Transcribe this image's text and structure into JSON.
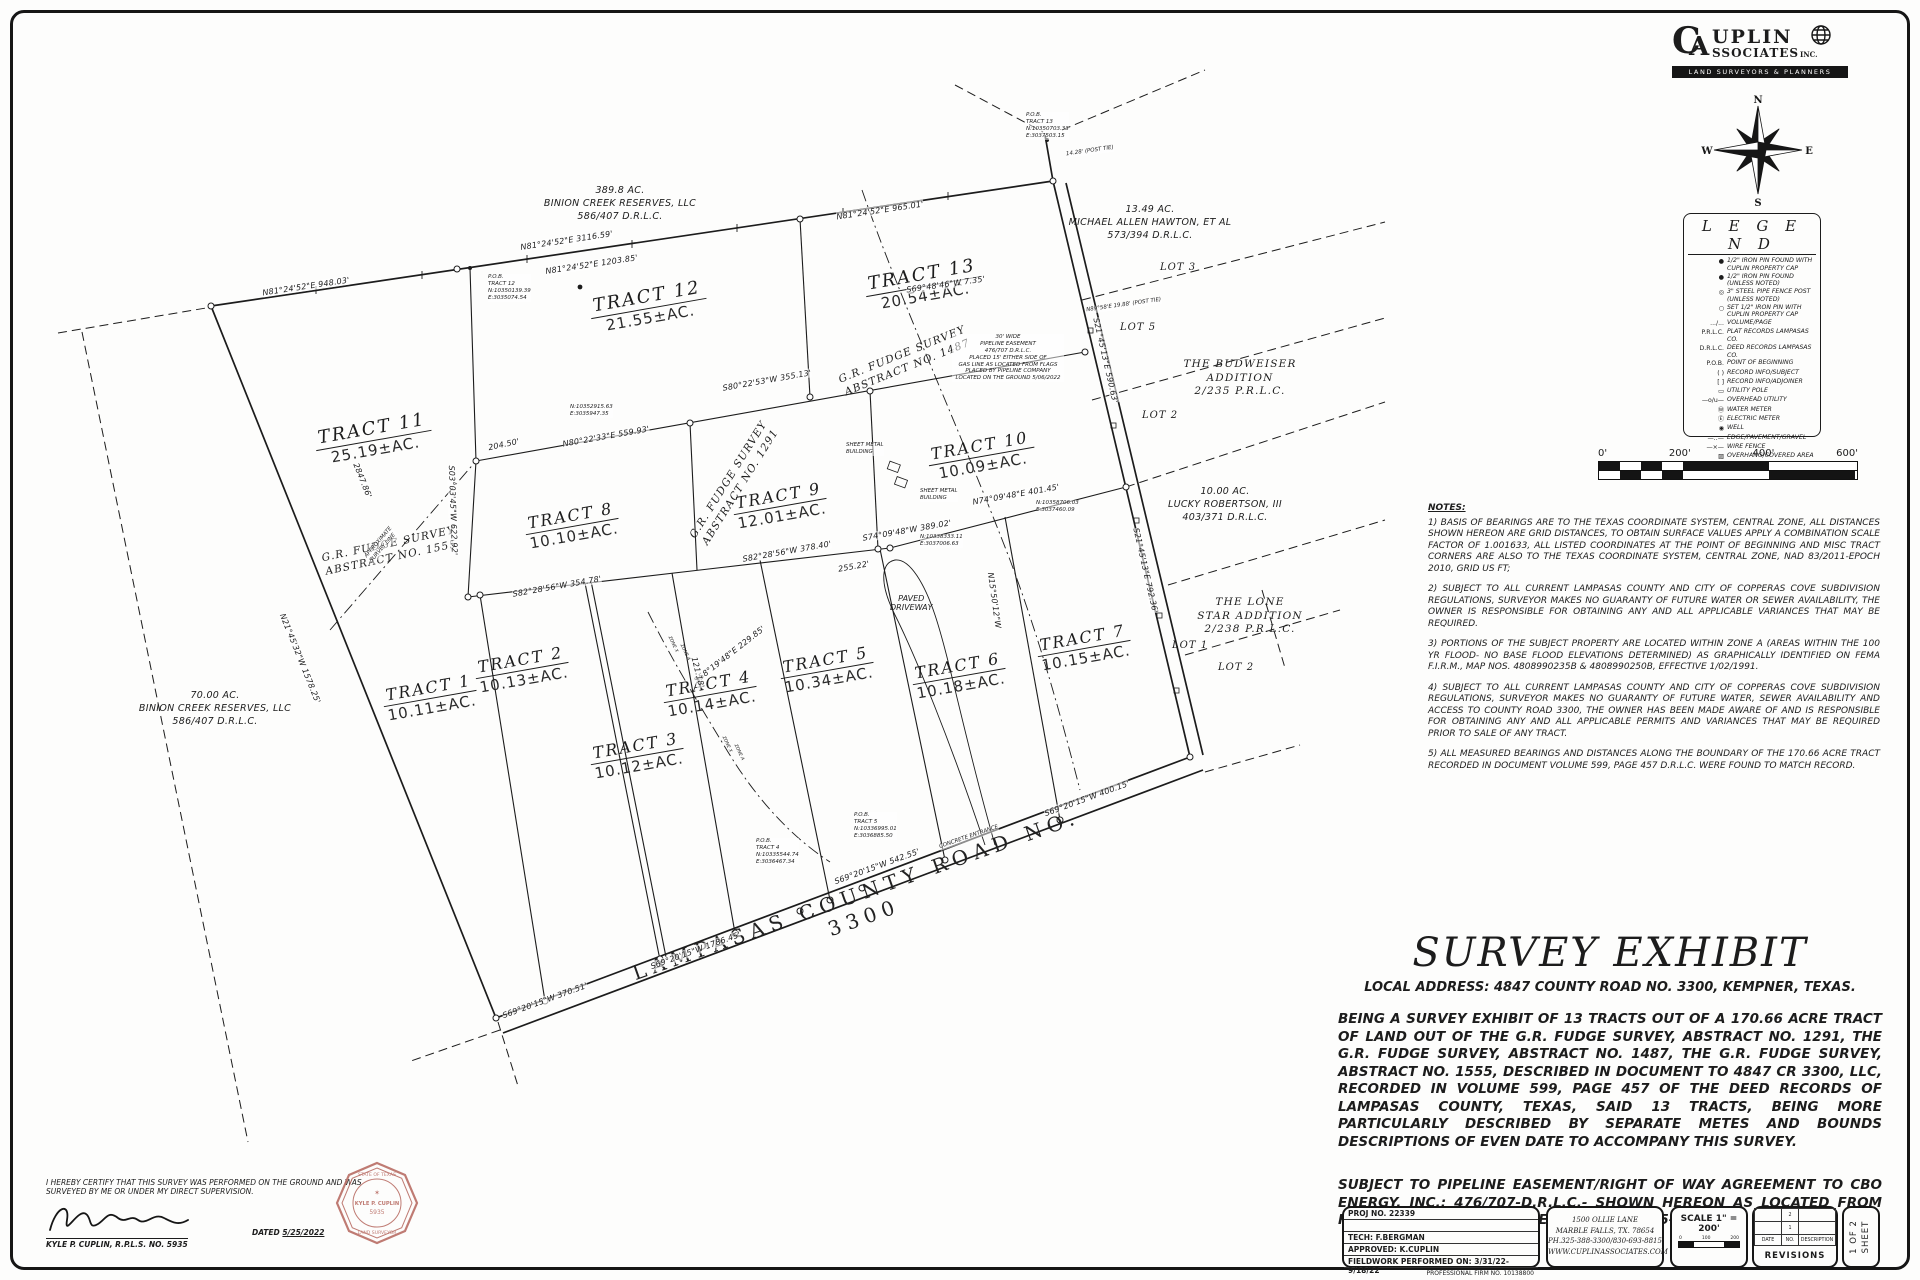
{
  "logo": {
    "c": "C",
    "a": "A",
    "upl": "UPLIN",
    "ssoc": "SSOCIATES",
    "inc": "INC.",
    "tagline": "LAND SURVEYORS & PLANNERS"
  },
  "compass": {
    "n": "N",
    "e": "E",
    "s": "S",
    "w": "W"
  },
  "legend": {
    "title": "L E G E N D",
    "items": [
      {
        "symbol": "●",
        "label": "1/2\" IRON PIN FOUND WITH CUPLIN PROPERTY CAP"
      },
      {
        "symbol": "●",
        "label": "1/2\" IRON PIN FOUND (UNLESS NOTED)"
      },
      {
        "symbol": "◎",
        "label": "3\" STEEL PIPE FENCE POST (UNLESS NOTED)"
      },
      {
        "symbol": "○",
        "label": "SET 1/2\" IRON PIN WITH CUPLIN PROPERTY CAP"
      },
      {
        "symbol": ".../...",
        "label": "VOLUME/PAGE"
      },
      {
        "symbol": "P.R.L.C.",
        "label": "PLAT RECORDS LAMPASAS CO."
      },
      {
        "symbol": "D.R.L.C.",
        "label": "DEED RECORDS LAMPASAS CO."
      },
      {
        "symbol": "P.O.B.",
        "label": "POINT OF BEGINNING"
      },
      {
        "symbol": "(  )",
        "label": "RECORD INFO/SUBJECT"
      },
      {
        "symbol": "[  ]",
        "label": "RECORD INFO/ADJOINER"
      },
      {
        "symbol": "▭",
        "label": "UTILITY POLE"
      },
      {
        "symbol": "—o/u—",
        "label": "OVERHEAD UTILITY"
      },
      {
        "symbol": "Ⓦ",
        "label": "WATER METER"
      },
      {
        "symbol": "Ⓔ",
        "label": "ELECTRIC METER"
      },
      {
        "symbol": "◉",
        "label": "WELL"
      },
      {
        "symbol": "—‥—",
        "label": "EDGE/PAVEMENT/GRAVEL"
      },
      {
        "symbol": "—×—",
        "label": "WIRE FENCE"
      },
      {
        "symbol": "▨",
        "label": "OVERHANG/COVERED AREA"
      },
      {
        "symbol": "◼",
        "label": "SIGN"
      }
    ]
  },
  "scalebar": {
    "t0": "0'",
    "t200": "200'",
    "t400": "400'",
    "t600": "600'"
  },
  "notes": {
    "heading": "NOTES:",
    "n1": "1) BASIS OF BEARINGS ARE TO THE TEXAS COORDINATE SYSTEM, CENTRAL ZONE, ALL DISTANCES SHOWN HEREON ARE GRID DISTANCES, TO OBTAIN SURFACE VALUES APPLY A COMBINATION SCALE FACTOR OF 1.001633, ALL LISTED COORDINATES AT THE POINT OF BEGINNING AND MISC TRACT CORNERS ARE ALSO TO THE TEXAS COORDINATE SYSTEM, CENTRAL ZONE, NAD 83/2011-EPOCH 2010, GRID US FT;",
    "n2": "2) SUBJECT TO ALL CURRENT LAMPASAS COUNTY AND CITY OF COPPERAS COVE SUBDIVISION REGULATIONS, SURVEYOR MAKES NO GUARANTY OF FUTURE WATER OR SEWER AVAILABILITY, THE OWNER IS RESPONSIBLE FOR OBTAINING ANY AND ALL APPLICABLE VARIANCES THAT MAY BE REQUIRED.",
    "n3": "3) PORTIONS OF THE SUBJECT PROPERTY ARE LOCATED WITHIN ZONE A (AREAS WITHIN THE 100 YR FLOOD- NO BASE FLOOD ELEVATIONS DETERMINED) AS GRAPHICALLY IDENTIFIED ON FEMA F.I.R.M., MAP NOS. 4808990235B & 4808990250B, EFFECTIVE 1/02/1991.",
    "n4": "4) SUBJECT TO ALL CURRENT LAMPASAS COUNTY AND CITY OF COPPERAS COVE SUBDIVISION REGULATIONS, SURVEYOR MAKES NO GUARANTY OF FUTURE WATER, SEWER AVAILABILITY AND ACCESS TO COUNTY ROAD 3300, THE OWNER HAS BEEN MADE AWARE OF AND IS RESPONSIBLE FOR OBTAINING ANY AND ALL APPLICABLE PERMITS AND VARIANCES THAT MAY BE REQUIRED PRIOR TO SALE OF ANY TRACT.",
    "n5": "5) ALL MEASURED BEARINGS AND DISTANCES ALONG THE BOUNDARY OF THE 170.66 ACRE TRACT RECORDED IN DOCUMENT VOLUME 599, PAGE 457 D.R.L.C. WERE FOUND TO MATCH RECORD."
  },
  "exhibit": {
    "title": "SURVEY EXHIBIT",
    "address": "LOCAL ADDRESS: 4847 COUNTY ROAD NO. 3300, KEMPNER, TEXAS.",
    "body": "BEING A SURVEY EXHIBIT OF 13 TRACTS OUT OF A 170.66 ACRE TRACT OF LAND OUT OF THE G.R. FUDGE SURVEY, ABSTRACT NO. 1291, THE G.R. FUDGE SURVEY, ABSTRACT NO. 1487, THE G.R. FUDGE SURVEY, ABSTRACT NO. 1555, DESCRIBED IN DOCUMENT TO 4847 CR 3300, LLC, RECORDED IN VOLUME 599, PAGE 457 OF THE DEED RECORDS OF LAMPASAS COUNTY, TEXAS, SAID 13 TRACTS, BEING MORE PARTICULARLY DESCRIBED BY SEPARATE METES AND BOUNDS DESCRIPTIONS OF EVEN DATE TO ACCOMPANY THIS SURVEY.",
    "pipeline": "SUBJECT TO PIPELINE EASEMENT/RIGHT OF WAY AGREEMENT TO CBO ENERGY, INC.: 476/707-D.R.L.C.- SHOWN HEREON AS LOCATED FROM FLAGS PLACED BY PIPELINE COMPANY ON 5-03-2022"
  },
  "certification": {
    "statement": "I HEREBY CERTIFY THAT THIS SURVEY WAS PERFORMED ON THE GROUND AND WAS SURVEYED BY ME OR UNDER MY DIRECT SUPERVISION.",
    "signer": "KYLE P. CUPLIN, R.P.L.S. NO. 5935",
    "dated_label": "DATED",
    "date": "5/25/2022",
    "seal_top": "STATE OF TEXAS",
    "seal_name": "KYLE P. CUPLIN",
    "seal_number": "5935",
    "seal_bottom": "LAND SURVEYOR"
  },
  "titleblock": {
    "proj": "PROJ NO. 22339",
    "tech": "TECH: F.BERGMAN",
    "approved": "APPROVED: K.CUPLIN",
    "fieldwork": "FIELDWORK PERFORMED ON: 3/31/22-9/18/22",
    "firm": "PROFESSIONAL FIRM NO. 10138800",
    "addr1": "1500 OLLIE LANE",
    "addr2": "MARBLE FALLS, TX. 78654",
    "addr3": "PH.325-388-3300/830-693-8815",
    "addr4": "WWW.CUPLINASSOCIATES.COM",
    "scale": "SCALE 1\" = 200'",
    "tick0": "0",
    "tick100": "100",
    "tick200": "200",
    "rev_date": "DATE",
    "rev_no": "NO.",
    "rev_desc": "DESCRIPTION",
    "rev_title": "REVISIONS",
    "rev_row1": "2",
    "rev_row2": "1",
    "sheet_line1": "1 OF 2",
    "sheet_line2": "SHEET"
  },
  "map": {
    "road_label": "LAMPASAS COUNTY ROAD NO. 3300",
    "tracts": [
      {
        "name": "TRACT 1",
        "area": "10.11±AC."
      },
      {
        "name": "TRACT 2",
        "area": "10.13±AC."
      },
      {
        "name": "TRACT 3",
        "area": "10.12±AC."
      },
      {
        "name": "TRACT 4",
        "area": "10.14±AC."
      },
      {
        "name": "TRACT 5",
        "area": "10.34±AC."
      },
      {
        "name": "TRACT 6",
        "area": "10.18±AC."
      },
      {
        "name": "TRACT 7",
        "area": "10.15±AC."
      },
      {
        "name": "TRACT 8",
        "area": "10.10±AC."
      },
      {
        "name": "TRACT 9",
        "area": "12.01±AC."
      },
      {
        "name": "TRACT 10",
        "area": "10.09±AC."
      },
      {
        "name": "TRACT 11",
        "area": "25.19±AC."
      },
      {
        "name": "TRACT 12",
        "area": "21.55±AC."
      },
      {
        "name": "TRACT 13",
        "area": "20.54±AC."
      }
    ],
    "adjoiners": {
      "binion_north": "389.8 AC.\nBINION CREEK RESERVES, LLC\n586/407 D.R.L.C.",
      "hawton": "13.49 AC.\nMICHAEL ALLEN HAWTON, ET AL\n573/394 D.R.L.C.",
      "budweiser": "THE BUDWEISER\nADDITION\n2/235 P.R.L.C.",
      "robertson": "10.00 AC.\nLUCKY ROBERTSON, III\n403/371 D.R.L.C.",
      "lonestar": "THE LONE\nSTAR ADDITION\n2/238 P.R.L.C.",
      "binion_west": "70.00 AC.\nBINION CREEK RESERVES, LLC\n586/407 D.R.L.C."
    },
    "surveys": {
      "s1555": "G.R. FUDGE SURVEY\nABSTRACT NO. 1555",
      "s1291": "G.R. FUDGE SURVEY\nABSTRACT NO. 1291",
      "s1487": "G.R. FUDGE SURVEY\nABSTRACT NO. 1487"
    },
    "lots": {
      "lot1": "LOT 1",
      "lot2_budweiser": "LOT 2",
      "lot2_lonestar": "LOT 2",
      "lot3": "LOT 3",
      "lot5": "LOT 5"
    },
    "bearings": {
      "b1": "N81°24'52\"E  948.03'",
      "b2": "N81°24'52\"E  3116.59'",
      "b3": "N81°24'52\"E  1203.85'",
      "b4": "N81°24'52\"E  965.01'",
      "b5": "S80°22'53\"W  355.13'",
      "b6": "N80°22'33\"E  559.93'",
      "b7": "204.50'",
      "b8": "S82°28'56\"W  378.40'",
      "b9": "S82°28'56\"W  354.78'",
      "b10": "255.22'",
      "b11": "S74°09'48\"W  389.02'",
      "b12": "N74°09'48\"E  401.45'",
      "b13": "S69°20'15\"W  1786.45'",
      "b14": "S69°20'15\"W  370.51'",
      "b15": "S69°20'15\"W  542.55'",
      "b16": "S69°20'15\"W  400.15'",
      "b17": "N21°45'32\"W  1578.25'",
      "b18": "2847.86'",
      "b19": "S21°45'13\"E  590.63'",
      "b20": "S21°45'13\"E  792.36'",
      "b21": "S69°48'46\"W  7.35'",
      "b22": "S03°03'45\"W  622.92'",
      "b23": "S58°19'48\"E  229.85'",
      "b24": "121.18'",
      "b25": "N15°50'12\"W",
      "t1": "14.28' (POST TIE)",
      "t2": "N89°58'E  19.88' (POST TIE)"
    },
    "pobs": {
      "t12": "P.O.B.\nTRACT 12\nN:10350139.39\nE:3035074.54",
      "t13": "P.O.B.\nTRACT 13\nN:10350703.33\nE:3037503.15",
      "t4": "P.O.B.\nTRACT 4\nN:10335544.74\nE:3036467.34",
      "t5": "P.O.B.\nTRACT 5\nN:10336995.01\nE:3036885.50",
      "c1": "N:10352915.63\nE:3035947.35",
      "c2": "N:10358706.03\nE:3037460.09",
      "c3": "N:10338333.11\nE:3037006.63"
    },
    "labels": {
      "paved_driveway": "PAVED\nDRIVEWAY",
      "concrete_entrance": "CONCRETE ENTRANCE",
      "sheet_metal_1": "SHEET METAL\nBUILDING",
      "sheet_metal_2": "SHEET METAL\nBUILDING",
      "approx_line": "APPROXIMATE\nSURVEY LINE",
      "zone_a": "ZONE A",
      "zone_x": "ZONE X",
      "pipeline_note": "30' WIDE\nPIPELINE EASEMENT\n476/707 D.R.L.C.\nPLACED 15' EITHER SIDE OF\nGAS LINE AS LOCATED FROM FLAGS\nPLACED BY PIPELINE COMPANY\nLOCATED ON THE GROUND 5/06/2022"
    }
  }
}
